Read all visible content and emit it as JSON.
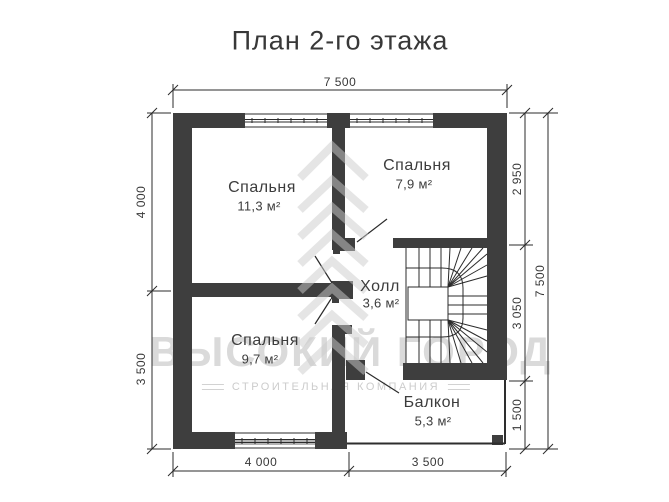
{
  "title": "План 2-го этажа",
  "rooms": {
    "bedroom1": {
      "name": "Спальня",
      "area": "11,3 м²"
    },
    "bedroom2": {
      "name": "Спальня",
      "area": "7,9 м²"
    },
    "hall": {
      "name": "Холл",
      "area": "3,6 м²"
    },
    "bedroom3": {
      "name": "Спальня",
      "area": "9,7 м²"
    },
    "balcony": {
      "name": "Балкон",
      "area": "5,3 м²"
    }
  },
  "dimensions": {
    "top_total": "7 500",
    "left_top": "4 000",
    "left_bottom": "3 500",
    "right_top": "2 950",
    "right_middle": "3 050",
    "right_bottom": "1 500",
    "right_total": "7 500",
    "bottom_left": "4 000",
    "bottom_right": "3 500"
  },
  "watermark": {
    "line1": "ВЫСОКИЙ ГОРОД",
    "line2": "СТРОИТЕЛЬНАЯ КОМПАНИЯ"
  },
  "colors": {
    "wall": "#3e3e3e",
    "line": "#2b2b2b",
    "text": "#3c3c3c",
    "watermark": "#dadada"
  }
}
